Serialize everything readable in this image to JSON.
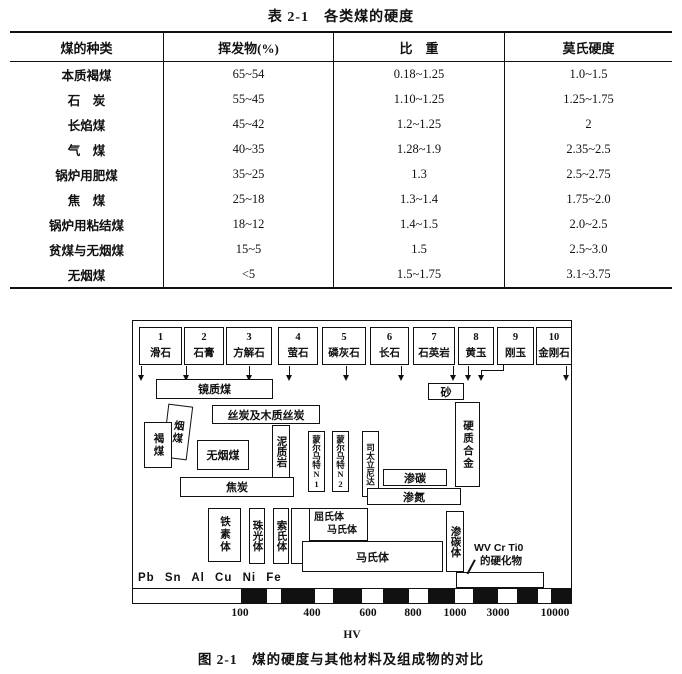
{
  "table": {
    "title": "表 2-1　各类煤的硬度",
    "headers": [
      "煤的种类",
      "挥发物(%)",
      "比　重",
      "莫氏硬度"
    ],
    "rows": [
      [
        "本质褐煤",
        "65~54",
        "0.18~1.25",
        "1.0~1.5"
      ],
      [
        "石　炭",
        "55~45",
        "1.10~1.25",
        "1.25~1.75"
      ],
      [
        "长焰煤",
        "45~42",
        "1.2~1.25",
        "2"
      ],
      [
        "气　煤",
        "40~35",
        "1.28~1.9",
        "2.35~2.5"
      ],
      [
        "锅炉用肥煤",
        "35~25",
        "1.3",
        "2.5~2.75"
      ],
      [
        "焦　煤",
        "25~18",
        "1.3~1.4",
        "1.75~2.0"
      ],
      [
        "锅炉用粘结煤",
        "18~12",
        "1.4~1.5",
        "2.0~2.5"
      ],
      [
        "贫煤与无烟煤",
        "15~5",
        "1.5",
        "2.5~3.0"
      ],
      [
        "无烟煤",
        "<5",
        "1.5~1.75",
        "3.1~3.75"
      ]
    ]
  },
  "figure": {
    "minerals": [
      {
        "num": "1",
        "name": "滑石"
      },
      {
        "num": "2",
        "name": "石膏"
      },
      {
        "num": "3",
        "name": "方解石"
      },
      {
        "num": "4",
        "name": "萤石"
      },
      {
        "num": "5",
        "name": "磷灰石"
      },
      {
        "num": "6",
        "name": "长石"
      },
      {
        "num": "7",
        "name": "石英岩"
      },
      {
        "num": "8",
        "name": "黄玉"
      },
      {
        "num": "9",
        "name": "刚玉"
      },
      {
        "num": "10",
        "name": "金刚石"
      }
    ],
    "boxes": {
      "vitrinite": "镜质煤",
      "sand": "砂",
      "fusain": "丝炭及木质丝炭",
      "bituminous": "烟煤",
      "lignite": "褐煤",
      "anthracite": "无烟煤",
      "mudstone": "泥质岩",
      "monel1": "蒙尔马特N1",
      "monel2": "蒙尔马特N2",
      "stellite": "司太立尼达",
      "carburized": "渗碳",
      "nitrided": "渗氮",
      "hard_alloy": "硬质合金",
      "coke": "焦炭",
      "ferrite": "铁素体",
      "pearlite": "珠光体",
      "sorbite": "索氏体",
      "troostite_line1": "屈氏体",
      "troostite_line2": "马氏体",
      "martensite": "马氏体",
      "cementite": "渗碳体"
    },
    "carbide_note": {
      "line1": "WV Cr Ti0",
      "line2": "的硬化物"
    },
    "metals": "Pb Sn Al Cu Ni Fe",
    "axis": {
      "ticks": [
        "100",
        "400",
        "600",
        "800",
        "1000",
        "3000",
        "10000"
      ],
      "label": "HV"
    }
  },
  "caption": "图 2-1　煤的硬度与其他材料及组成物的对比"
}
